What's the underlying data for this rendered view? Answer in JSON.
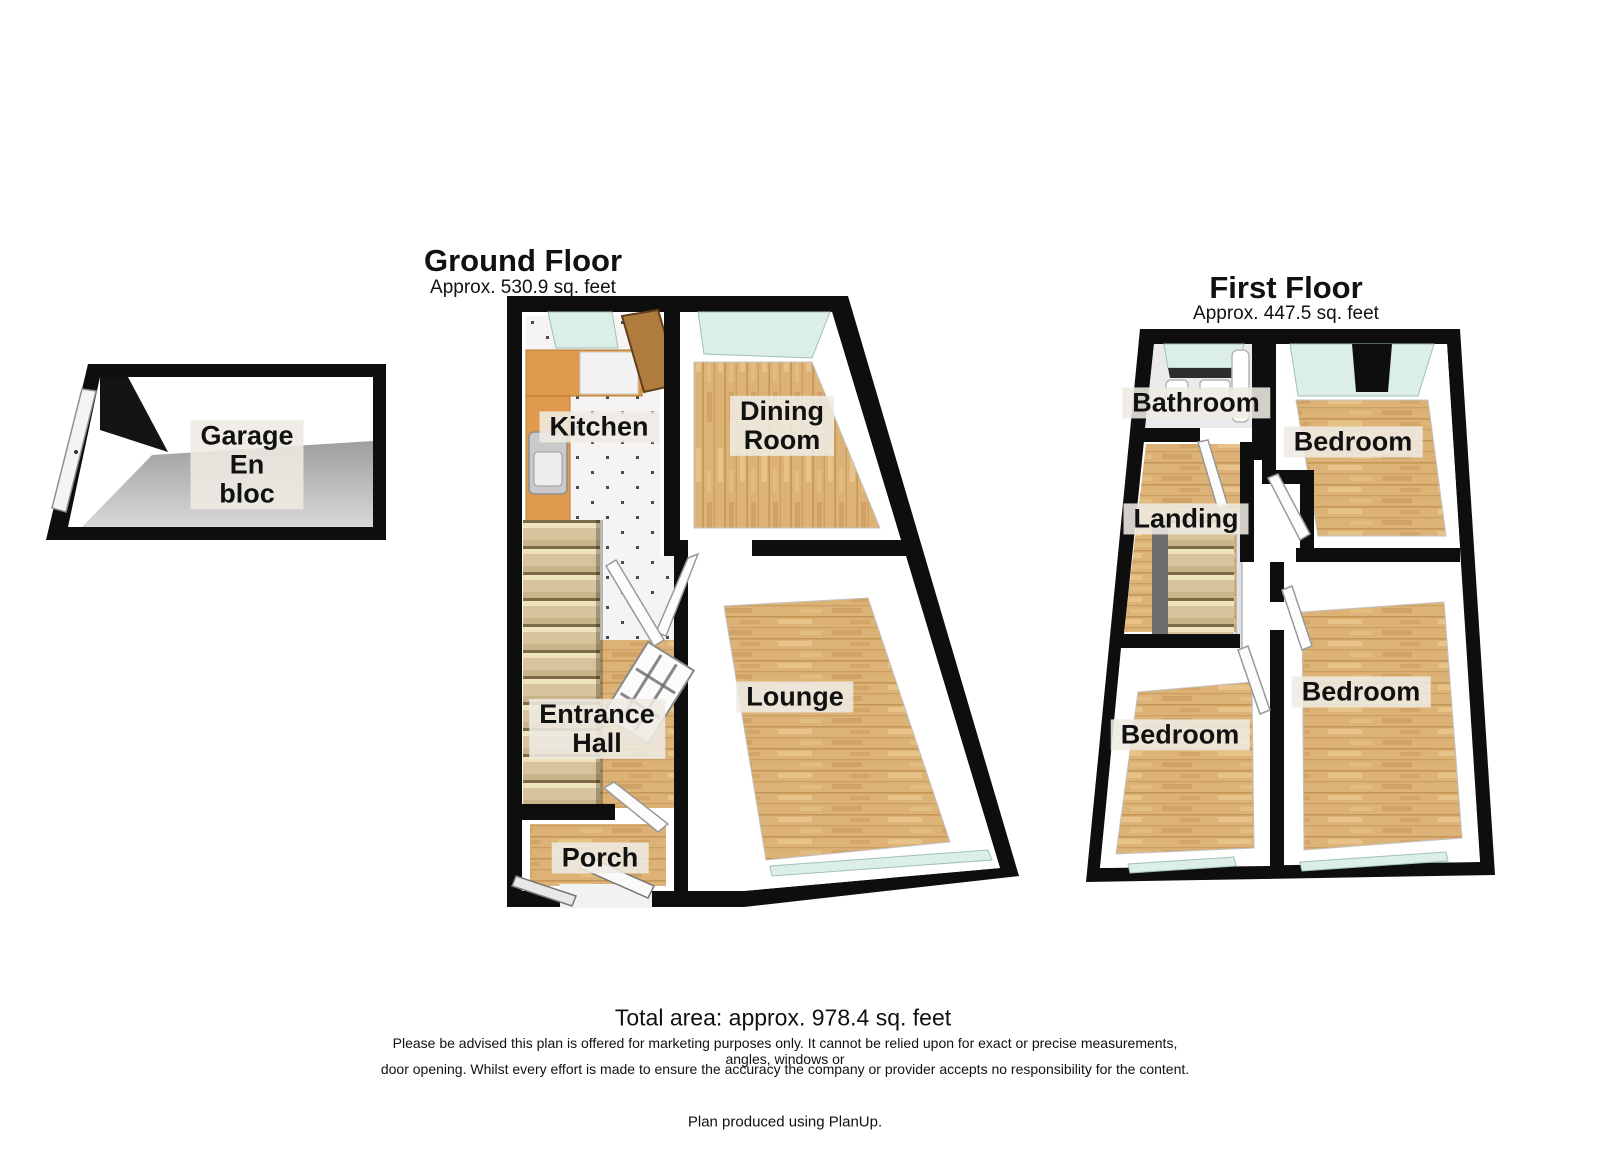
{
  "ground_floor": {
    "title": "Ground Floor",
    "subtitle": "Approx. 530.9 sq. feet",
    "rooms": {
      "kitchen": "Kitchen",
      "dining_room": "Dining\nRoom",
      "lounge": "Lounge",
      "entrance_hall": "Entrance\nHall",
      "porch": "Porch"
    }
  },
  "first_floor": {
    "title": "First Floor",
    "subtitle": "Approx. 447.5 sq. feet",
    "rooms": {
      "bathroom": "Bathroom",
      "bedroom_front": "Bedroom",
      "landing": "Landing",
      "bedroom_back_left": "Bedroom",
      "bedroom_back_right": "Bedroom"
    }
  },
  "garage": {
    "label": "Garage\nEn\nbloc"
  },
  "footer": {
    "total_area": "Total area: approx. 978.4 sq. feet",
    "disclaimer_line1": "Please be advised this plan is offered for marketing purposes only. It cannot be relied upon for exact or precise measurements, angles, windows or",
    "disclaimer_line2": "door opening. Whilst every effort is made to ensure the accuracy the company or provider accepts no responsibility for the content.",
    "credit": "Plan produced using PlanUp."
  },
  "colors": {
    "wall": "#0e0e0e",
    "wood_floor": "#ddb277",
    "tile_floor": "#f5f4f2",
    "window_glass": "#dceee8",
    "stairs": "#d7c49c",
    "counter": "#e09a4e",
    "garage_floor": "#b9b9b9",
    "label_background": "#eeeae3"
  }
}
